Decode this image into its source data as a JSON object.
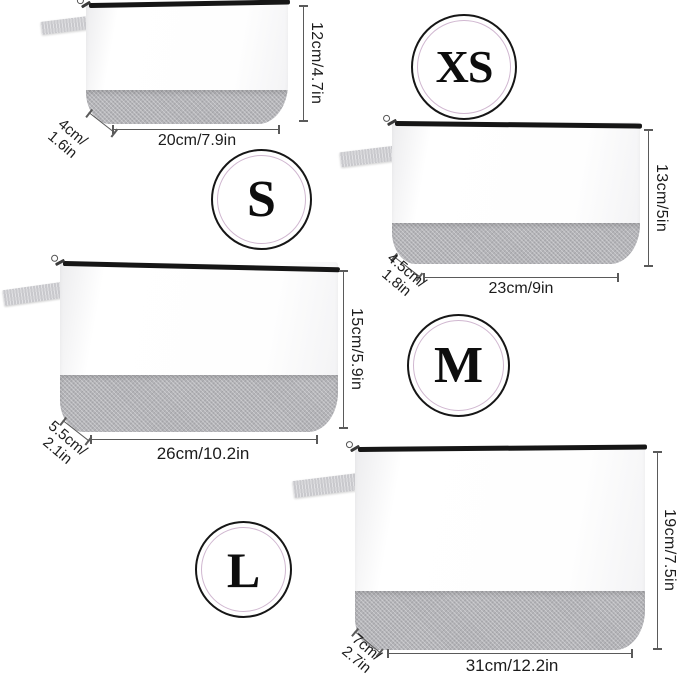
{
  "colors": {
    "line": "#5a5a5a",
    "text": "#1c1c1c",
    "band": "#b4b4b8",
    "tab": "#c9c9cd",
    "zipper": "#161616",
    "badge-outer": "#161616",
    "badge-inner": "#d0b7d0"
  },
  "bags": [
    {
      "size_badge": "XS",
      "height_label": "12cm/4.7in",
      "width_label": "20cm/7.9in",
      "depth_line1": "4cm/",
      "depth_line2": "1.6in"
    },
    {
      "size_badge": "S",
      "height_label": "13cm/5in",
      "width_label": "23cm/9in",
      "depth_line1": "4.5cm/",
      "depth_line2": "1.8in"
    },
    {
      "size_badge": "M",
      "height_label": "15cm/5.9in",
      "width_label": "26cm/10.2in",
      "depth_line1": "5.5cm/",
      "depth_line2": "2.1in"
    },
    {
      "size_badge": "L",
      "height_label": "19cm/7.5in",
      "width_label": "31cm/12.2in",
      "depth_line1": "7cm/",
      "depth_line2": "2.7in"
    }
  ]
}
